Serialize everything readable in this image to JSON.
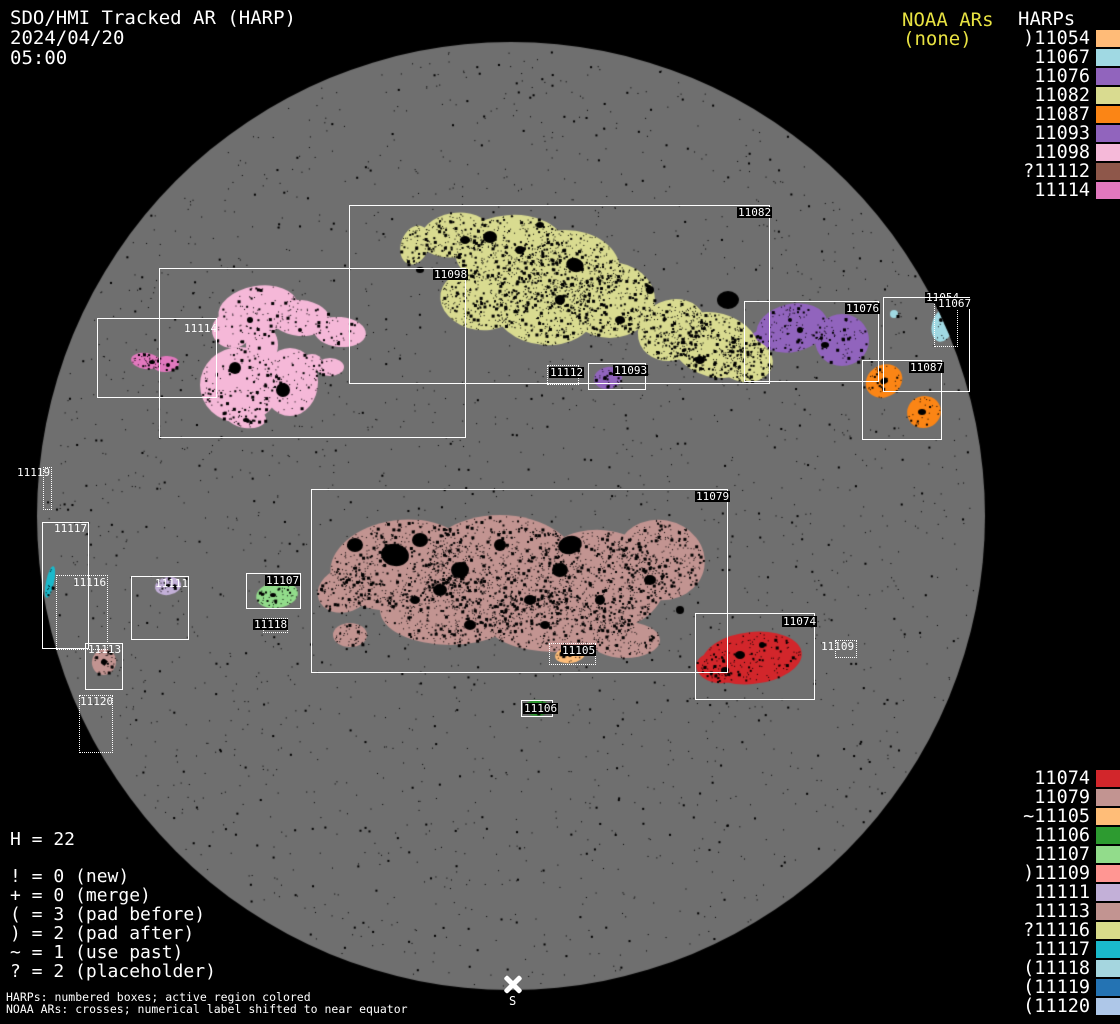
{
  "header": {
    "title": "SDO/HMI Tracked AR (HARP)",
    "date": "2024/04/20",
    "time": "05:00"
  },
  "noaa": {
    "label": "NOAA ARs",
    "value": "(none)",
    "color": "#e8e242"
  },
  "harps_panel": {
    "title": "HARPs",
    "top_list": [
      {
        "text": ")11054",
        "color": "#ffbb78"
      },
      {
        "text": "11067",
        "color": "#a0d9e3"
      },
      {
        "text": "11076",
        "color": "#9164bd"
      },
      {
        "text": "11082",
        "color": "#d9db90"
      },
      {
        "text": "11087",
        "color": "#fb8515"
      },
      {
        "text": "11093",
        "color": "#9164bd"
      },
      {
        "text": "11098",
        "color": "#f5b8d8"
      },
      {
        "text": "?11112",
        "color": "#8e574a"
      },
      {
        "text": "11114",
        "color": "#e278be"
      }
    ],
    "bottom_list": [
      {
        "text": "11074",
        "color": "#d2262b"
      },
      {
        "text": "11079",
        "color": "#c29491"
      },
      {
        "text": "~11105",
        "color": "#ffbd78"
      },
      {
        "text": "11106",
        "color": "#2d9b30"
      },
      {
        "text": "11107",
        "color": "#92dc8b"
      },
      {
        "text": ")11109",
        "color": "#ff9693"
      },
      {
        "text": "11111",
        "color": "#c3b0d8"
      },
      {
        "text": "11113",
        "color": "#c29491"
      },
      {
        "text": "?11116",
        "color": "#d8db8a"
      },
      {
        "text": "11117",
        "color": "#1ab9cb"
      },
      {
        "text": "(11118",
        "color": "#a5d6df"
      },
      {
        "text": "(11119",
        "color": "#2473b3"
      },
      {
        "text": "(11120",
        "color": "#aec7e8"
      }
    ]
  },
  "stats": {
    "h_line": "H = 22"
  },
  "flag_legend": {
    "lines": [
      "! = 0 (new)",
      "+ = 0 (merge)",
      "( = 3 (pad before)",
      ") = 2 (pad after)",
      "~ = 1 (use past)",
      "? = 2 (placeholder)"
    ]
  },
  "footer": {
    "line1": "HARPs: numbered boxes; active region colored",
    "line2": "NOAA ARs: crosses; numerical label shifted to near equator"
  },
  "disk": {
    "south_label": "S",
    "regions": [
      {
        "id": "11054",
        "label": "11054",
        "prefix": ")",
        "color": "#ffbb78"
      },
      {
        "id": "11067",
        "label": "11067",
        "prefix": "",
        "color": "#a0d9e3"
      },
      {
        "id": "11076",
        "label": "11076",
        "prefix": "",
        "color": "#9164bd"
      },
      {
        "id": "11082",
        "label": "11082",
        "prefix": "",
        "color": "#d9db90"
      },
      {
        "id": "11087",
        "label": "11087",
        "prefix": "",
        "color": "#fb8515"
      },
      {
        "id": "11093",
        "label": "11093",
        "prefix": "",
        "color": "#9164bd"
      },
      {
        "id": "11098",
        "label": "11098",
        "prefix": "",
        "color": "#f5b8d8"
      },
      {
        "id": "11112",
        "label": "11112",
        "prefix": "?",
        "color": "#8e574a"
      },
      {
        "id": "11114",
        "label": "11114",
        "prefix": "",
        "color": "#e278be"
      },
      {
        "id": "11074",
        "label": "11074",
        "prefix": "",
        "color": "#d2262b"
      },
      {
        "id": "11079",
        "label": "11079",
        "prefix": "",
        "color": "#c29491"
      },
      {
        "id": "11105",
        "label": "11105",
        "prefix": "~",
        "color": "#ffbd78"
      },
      {
        "id": "11106",
        "label": "11106",
        "prefix": "",
        "color": "#2d9b30"
      },
      {
        "id": "11107",
        "label": "11107",
        "prefix": "",
        "color": "#92dc8b"
      },
      {
        "id": "11109",
        "label": "11109",
        "prefix": ")",
        "color": "#ff9693"
      },
      {
        "id": "11111",
        "label": "11111",
        "prefix": "",
        "color": "#c3b0d8"
      },
      {
        "id": "11113",
        "label": "11113",
        "prefix": "",
        "color": "#c29491"
      },
      {
        "id": "11116",
        "label": "11116",
        "prefix": "?",
        "color": "#d8db8a"
      },
      {
        "id": "11117",
        "label": "11117",
        "prefix": "",
        "color": "#1ab9cb"
      },
      {
        "id": "11118",
        "label": "11118",
        "prefix": "(",
        "color": "#a5d6df"
      },
      {
        "id": "11119",
        "label": "11119",
        "prefix": "(",
        "color": "#2473b3"
      },
      {
        "id": "11120",
        "label": "11120",
        "prefix": "(",
        "color": "#aec7e8"
      }
    ]
  },
  "chart_data": {
    "type": "scatter",
    "title": "SDO/HMI Tracked AR (HARP)",
    "timestamp": "2024/04/20 05:00",
    "noaa_ars": "(none)",
    "harp_count": 22,
    "flag_counts": {
      "new": 0,
      "merge": 0,
      "pad_before": 3,
      "pad_after": 2,
      "use_past": 1,
      "placeholder": 2
    },
    "legend_position": "right",
    "points": [
      {
        "id": 11054,
        "flag": "pad after",
        "color": "#ffbb78",
        "box_px": [
          934,
          292,
          24,
          55
        ]
      },
      {
        "id": 11067,
        "flag": "",
        "color": "#a0d9e3",
        "box_px": [
          883,
          297,
          87,
          95
        ]
      },
      {
        "id": 11076,
        "flag": "",
        "color": "#9164bd",
        "box_px": [
          744,
          301,
          135,
          81
        ]
      },
      {
        "id": 11082,
        "flag": "",
        "color": "#d9db90",
        "box_px": [
          349,
          205,
          421,
          179
        ]
      },
      {
        "id": 11087,
        "flag": "",
        "color": "#fb8515",
        "box_px": [
          862,
          360,
          80,
          80
        ]
      },
      {
        "id": 11093,
        "flag": "",
        "color": "#9164bd",
        "box_px": [
          588,
          363,
          58,
          27
        ]
      },
      {
        "id": 11098,
        "flag": "",
        "color": "#f5b8d8",
        "box_px": [
          159,
          268,
          307,
          170
        ]
      },
      {
        "id": 11112,
        "flag": "placeholder",
        "color": "#8e574a",
        "box_px": [
          547,
          365,
          32,
          20
        ]
      },
      {
        "id": 11114,
        "flag": "",
        "color": "#e278be",
        "box_px": [
          97,
          318,
          120,
          80
        ]
      },
      {
        "id": 11074,
        "flag": "",
        "color": "#d2262b",
        "box_px": [
          695,
          613,
          120,
          87
        ]
      },
      {
        "id": 11079,
        "flag": "",
        "color": "#c29491",
        "box_px": [
          311,
          489,
          417,
          184
        ]
      },
      {
        "id": 11105,
        "flag": "use past",
        "color": "#ffbd78",
        "box_px": [
          549,
          643,
          47,
          22
        ]
      },
      {
        "id": 11106,
        "flag": "",
        "color": "#2d9b30",
        "box_px": [
          521,
          700,
          32,
          17
        ]
      },
      {
        "id": 11107,
        "flag": "",
        "color": "#92dc8b",
        "box_px": [
          246,
          573,
          55,
          36
        ]
      },
      {
        "id": 11109,
        "flag": "pad after",
        "color": "#ff9693",
        "box_px": [
          835,
          640,
          22,
          18
        ]
      },
      {
        "id": 11111,
        "flag": "",
        "color": "#c3b0d8",
        "box_px": [
          131,
          576,
          58,
          64
        ]
      },
      {
        "id": 11113,
        "flag": "",
        "color": "#c29491",
        "box_px": [
          85,
          643,
          38,
          47
        ]
      },
      {
        "id": 11116,
        "flag": "placeholder",
        "color": "#d8db8a",
        "box_px": [
          56,
          575,
          52,
          75
        ]
      },
      {
        "id": 11117,
        "flag": "",
        "color": "#1ab9cb",
        "box_px": [
          42,
          522,
          47,
          127
        ]
      },
      {
        "id": 11118,
        "flag": "pad before",
        "color": "#a5d6df",
        "box_px": [
          263,
          618,
          25,
          15
        ]
      },
      {
        "id": 11119,
        "flag": "pad before",
        "color": "#2473b3",
        "box_px": [
          43,
          467,
          9,
          43
        ]
      },
      {
        "id": 11120,
        "flag": "pad before",
        "color": "#aec7e8",
        "box_px": [
          79,
          695,
          34,
          58
        ]
      }
    ]
  }
}
